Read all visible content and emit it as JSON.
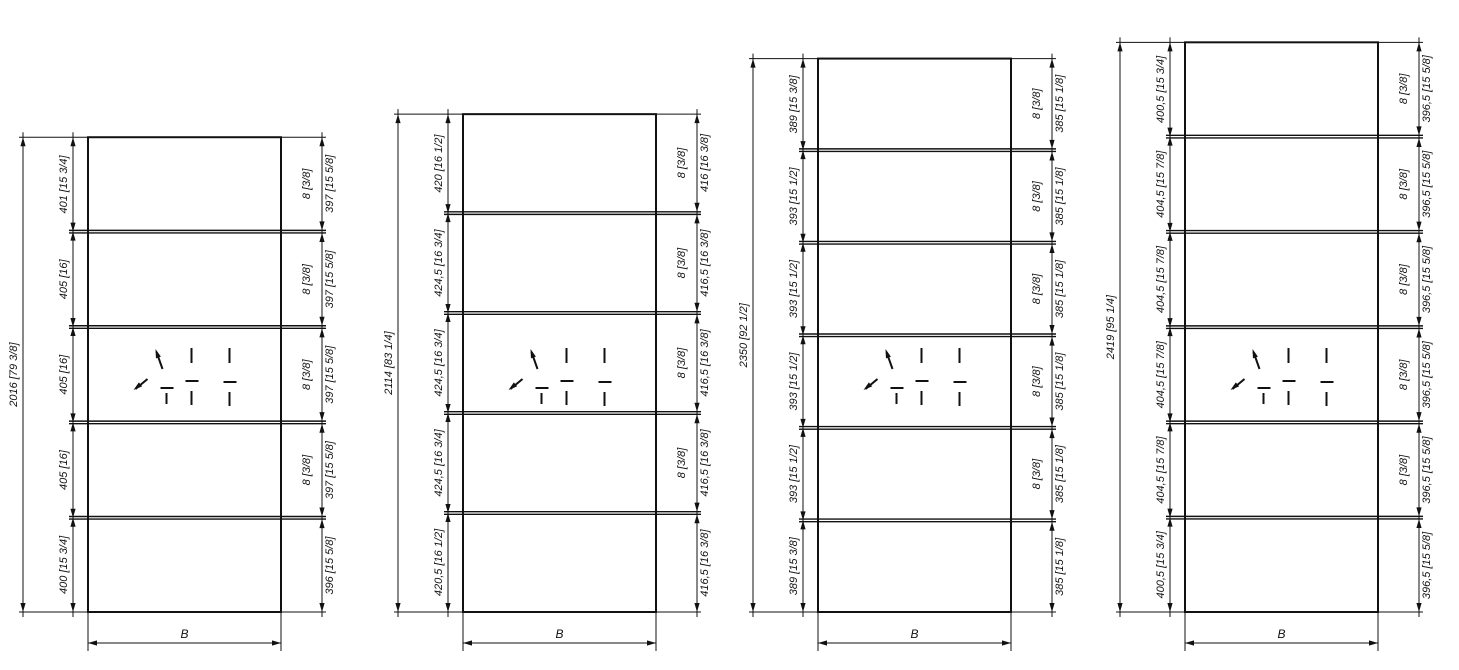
{
  "page": {
    "background_color": "#ffffff",
    "line_color": "#111111"
  },
  "drawings": [
    {
      "overall_height_label": "2016 [79 3/8]",
      "left_segment_labels": [
        "401 [15 3/4]",
        "405 [16]",
        "405 [16]",
        "405 [16]",
        "400 [15 3/4]"
      ],
      "right_panel_labels": [
        "397 [15 5/8]",
        "397 [15 5/8]",
        "397 [15 5/8]",
        "397 [15 5/8]",
        "396 [15 5/8]"
      ],
      "rail_thickness_labels": [
        "8 [3/8]",
        "8 [3/8]",
        "8 [3/8]",
        "8 [3/8]"
      ],
      "width_label": "B",
      "center_symbol_icon": "direction-arrows-icon"
    },
    {
      "overall_height_label": "2114 [83 1/4]",
      "left_segment_labels": [
        "420 [16 1/2]",
        "424,5 [16 3/4]",
        "424,5 [16 3/4]",
        "424,5 [16 3/4]",
        "420,5 [16 1/2]"
      ],
      "right_panel_labels": [
        "416 [16 3/8]",
        "416,5 [16 3/8]",
        "416,5 [16 3/8]",
        "416,5 [16 3/8]",
        "416,5 [16 3/8]"
      ],
      "rail_thickness_labels": [
        "8 [3/8]",
        "8 [3/8]",
        "8 [3/8]",
        "8 [3/8]"
      ],
      "width_label": "B",
      "center_symbol_icon": "direction-arrows-icon"
    },
    {
      "overall_height_label": "2350 [92 1/2]",
      "left_segment_labels": [
        "389 [15 3/8]",
        "393 [15 1/2]",
        "393 [15 1/2]",
        "393 [15 1/2]",
        "393 [15 1/2]",
        "389 [15 3/8]"
      ],
      "right_panel_labels": [
        "385 [15 1/8]",
        "385 [15 1/8]",
        "385 [15 1/8]",
        "385 [15 1/8]",
        "385 [15 1/8]",
        "385 [15 1/8]"
      ],
      "rail_thickness_labels": [
        "8 [3/8]",
        "8 [3/8]",
        "8 [3/8]",
        "8 [3/8]",
        "8 [3/8]"
      ],
      "width_label": "B",
      "center_symbol_icon": "direction-arrows-icon"
    },
    {
      "overall_height_label": "2419 [95 1/4]",
      "left_segment_labels": [
        "400,5 [15 3/4]",
        "404,5 [15 7/8]",
        "404,5 [15 7/8]",
        "404,5 [15 7/8]",
        "404,5 [15 7/8]",
        "400,5 [15 3/4]"
      ],
      "right_panel_labels": [
        "396,5 [15 5/8]",
        "396,5 [15 5/8]",
        "396,5 [15 5/8]",
        "396,5 [15 5/8]",
        "396,5 [15 5/8]",
        "396,5 [15 5/8]"
      ],
      "rail_thickness_labels": [
        "8 [3/8]",
        "8 [3/8]",
        "8 [3/8]",
        "8 [3/8]",
        "8 [3/8]"
      ],
      "width_label": "B",
      "center_symbol_icon": "direction-arrows-icon"
    }
  ]
}
